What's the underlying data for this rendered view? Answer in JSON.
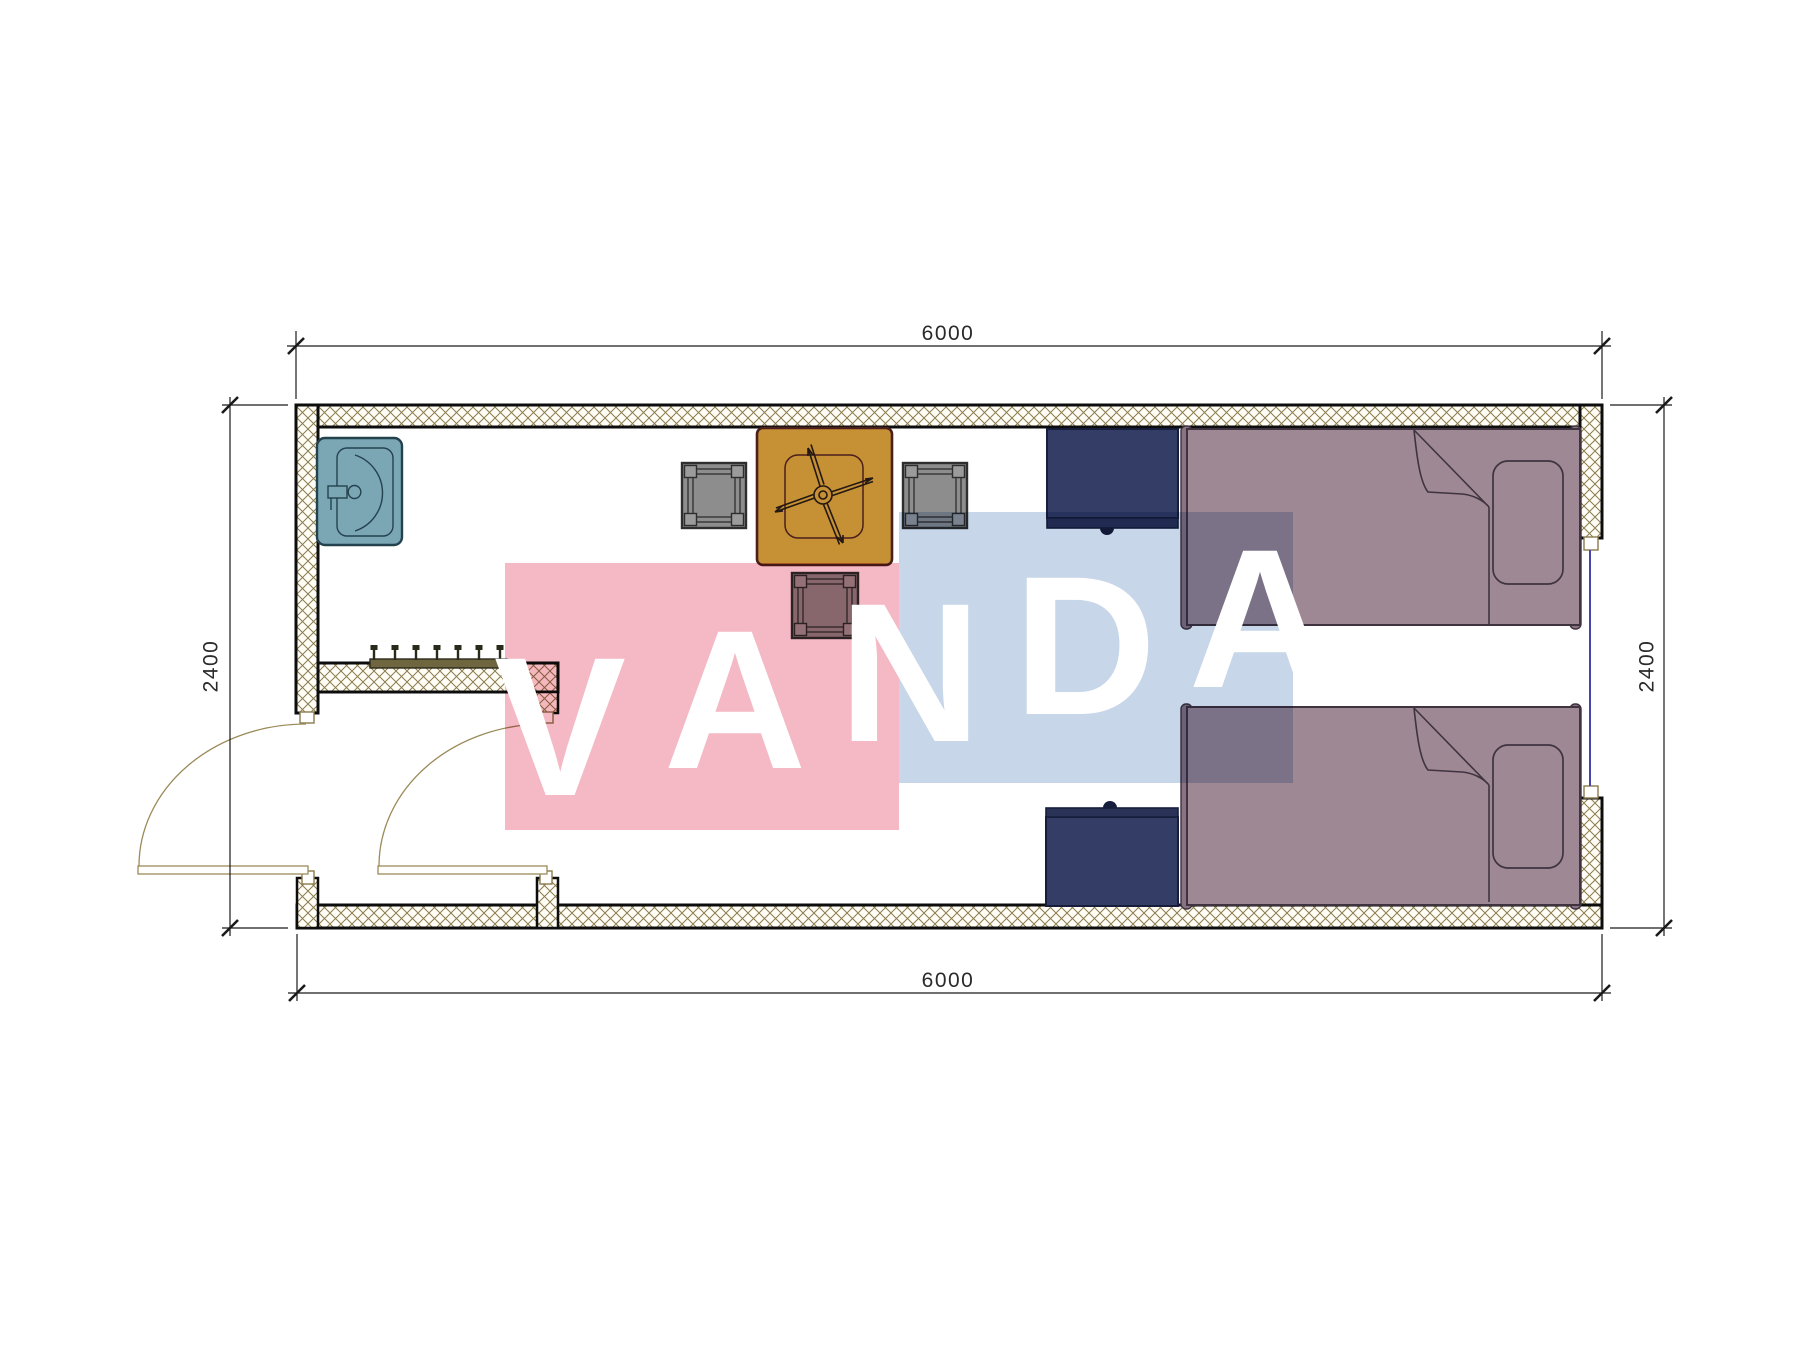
{
  "title": "Container room floor plan with furniture",
  "dimensions": {
    "top": {
      "label": "6000"
    },
    "bottom": {
      "label": "6000"
    },
    "left": {
      "label": "2400"
    },
    "right": {
      "label": "2400"
    }
  },
  "watermark": {
    "text": "VANDA",
    "letters": [
      {
        "char": "V"
      },
      {
        "char": "A"
      },
      {
        "char": "N"
      },
      {
        "char": "D"
      },
      {
        "char": "A"
      }
    ],
    "pink": "#f4b9c4",
    "blue": "#c7d6e9",
    "text_color": "#ffffff"
  },
  "colors": {
    "wall_fill": "#fffdf6",
    "wall_hatch_line": "#8a7c4e",
    "wall_border": "#0d0d0d",
    "jamb_outline": "#8a7c4e",
    "sink": "#7ba6b4",
    "sink_line": "#23424e",
    "table": "#c69035",
    "table_border": "#4a1f1c",
    "fan_line": "#241812",
    "chair": "#8d8d8d",
    "chair_line": "#2e2e2e",
    "chair_corner": "#9b9b9b",
    "nightstand": "#333d66",
    "nightstand_lip": "#2a3258",
    "nightstand_line": "#161e3c",
    "bed": "#9e8894",
    "bed_line": "#3f3340",
    "bed_frame_bar": "#8a7383",
    "coat_rack": "#6f663f",
    "coat_rack_hook": "#2a2a1a",
    "window": "#4444aa",
    "door": "#9b8a58",
    "dimension_line": "#1a1a1a"
  }
}
